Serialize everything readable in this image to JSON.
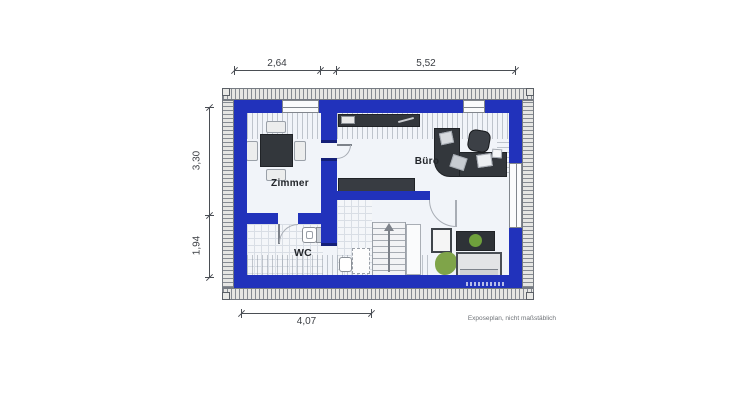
{
  "caption": "Exposeplan, nicht maßstäblich",
  "rooms": {
    "zimmer": "Zimmer",
    "buero": "Büro",
    "wc": "WC"
  },
  "dims": {
    "top_left": "2,64",
    "top_right": "5,52",
    "left_top": "3,30",
    "left_bottom": "1,94",
    "bottom": "4,07"
  },
  "colors": {
    "wall_blue": "#2132bb",
    "wall_blue_dark": "#141f78",
    "floor": "#f1f4f9",
    "furniture_dark": "#33373c",
    "hatch_line": "#868b92",
    "dimension": "#4a4e54",
    "plant_green": "#6fa03c"
  },
  "furniture_icons": {
    "zimmer": [
      "dining-table-icon",
      "chair-icon"
    ],
    "buero": [
      "corner-desk-icon",
      "office-chair-icon",
      "document-icon"
    ],
    "hall": [
      "sideboard-icon",
      "shelf-icon"
    ],
    "bath": [
      "sink-icon",
      "shower-dashed-icon"
    ],
    "wc": [
      "toilet-icon"
    ],
    "living": [
      "armchair-icon",
      "tv-board-icon",
      "sofa-icon",
      "plant-icon"
    ],
    "stairs": "stairs-up-arrow-icon"
  }
}
